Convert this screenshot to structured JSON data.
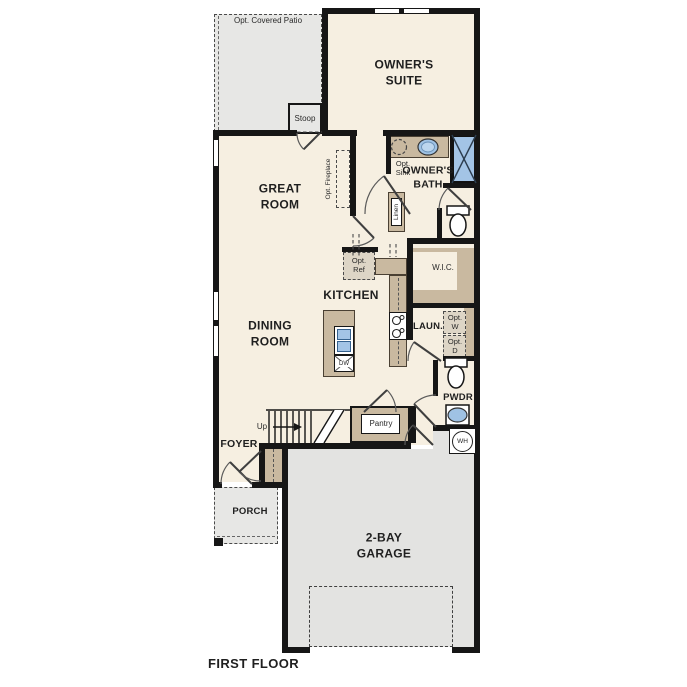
{
  "plan_title": "FIRST FLOOR",
  "colors": {
    "wall": "#161616",
    "floor": "#f6efe1",
    "gray": "#e7e7e5",
    "garage": "#e3e3e1",
    "tan": "#c9b9a0",
    "optfill": "#ddd5c6",
    "blue": "#a3c4e6",
    "ink": "#1f1f1f"
  },
  "labels": {
    "patio": "Opt. Covered Patio",
    "stoop": "Stoop",
    "owners_suite": "OWNER'S\nSUITE",
    "opt_sink": "Opt.\nSink",
    "owners_bath": "OWNER'S\nBATH",
    "linen": "Linen",
    "great_room": "GREAT\nROOM",
    "opt_fireplace": "Opt. Fireplace",
    "wic": "W.I.C.",
    "opt_ref": "Opt.\nRef",
    "kitchen": "KITCHEN",
    "dining_room": "DINING\nROOM",
    "laundry": "LAUN.",
    "opt_w": "Opt.\nW",
    "opt_d": "Opt.\nD",
    "pwdr": "PWDR",
    "wh": "WH",
    "up": "Up",
    "pantry": "Pantry",
    "foyer": "FOYER",
    "porch": "PORCH",
    "dw": "DW",
    "garage": "2-BAY\nGARAGE",
    "first_floor": "FIRST FLOOR"
  }
}
